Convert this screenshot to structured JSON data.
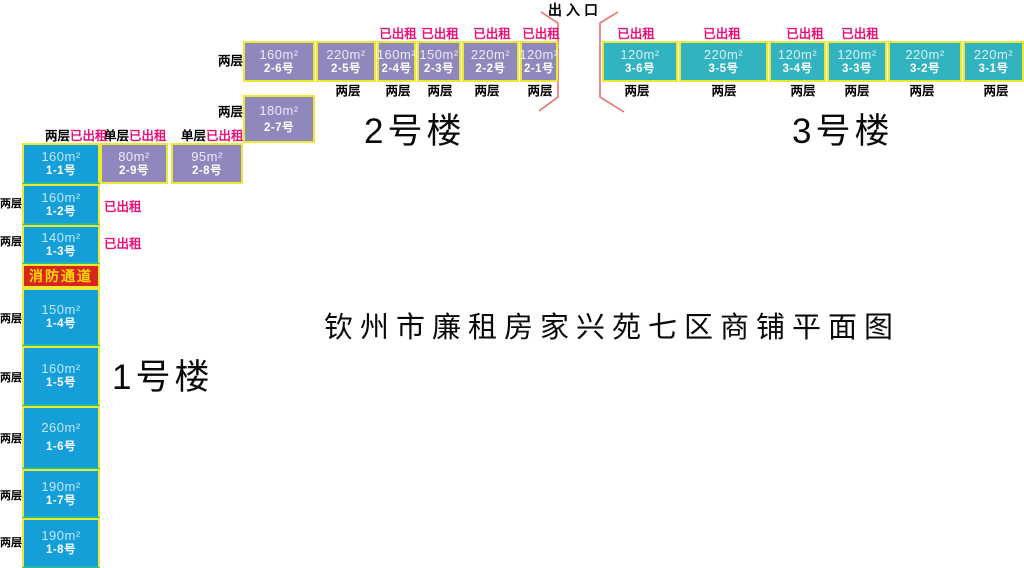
{
  "page": {
    "title": "钦州市廉租房家兴苑七区商铺平面图",
    "entrance": "出入口"
  },
  "labels": {
    "two_storey": "两层",
    "single_storey": "单层",
    "rented": "已出租",
    "fire_passage": "消防通道"
  },
  "buildings": {
    "b1": {
      "name": "1号楼",
      "units": [
        {
          "area": "160m²",
          "no": "1-1号"
        },
        {
          "area": "160m²",
          "no": "1-2号"
        },
        {
          "area": "140m²",
          "no": "1-3号"
        },
        {
          "area": "150m²",
          "no": "1-4号"
        },
        {
          "area": "160m²",
          "no": "1-5号"
        },
        {
          "area": "260m²",
          "no": "1-6号"
        },
        {
          "area": "190m²",
          "no": "1-7号"
        },
        {
          "area": "190m²",
          "no": "1-8号"
        }
      ]
    },
    "b2": {
      "name": "2号楼",
      "units": [
        {
          "area": "120m²",
          "no": "2-1号"
        },
        {
          "area": "220m²",
          "no": "2-2号"
        },
        {
          "area": "150m²",
          "no": "2-3号"
        },
        {
          "area": "160m²",
          "no": "2-4号"
        },
        {
          "area": "220m²",
          "no": "2-5号"
        },
        {
          "area": "160m²",
          "no": "2-6号"
        },
        {
          "area": "180m²",
          "no": "2-7号"
        },
        {
          "area": "95m²",
          "no": "2-8号"
        },
        {
          "area": "80m²",
          "no": "2-9号"
        }
      ]
    },
    "b3": {
      "name": "3号楼",
      "units": [
        {
          "area": "220m²",
          "no": "3-1号"
        },
        {
          "area": "220m²",
          "no": "3-2号"
        },
        {
          "area": "120m²",
          "no": "3-3号"
        },
        {
          "area": "120m²",
          "no": "3-4号"
        },
        {
          "area": "220m²",
          "no": "3-5号"
        },
        {
          "area": "120m²",
          "no": "3-6号"
        }
      ]
    }
  },
  "colors": {
    "building1": "#149fd9",
    "building2": "#8f88bd",
    "building3": "#32b3c0",
    "border": "#ece935",
    "rented_text": "#ea1178",
    "fire_bg": "#d9251d",
    "fire_text": "#ffd900",
    "entrance_marker": "#e87070"
  }
}
